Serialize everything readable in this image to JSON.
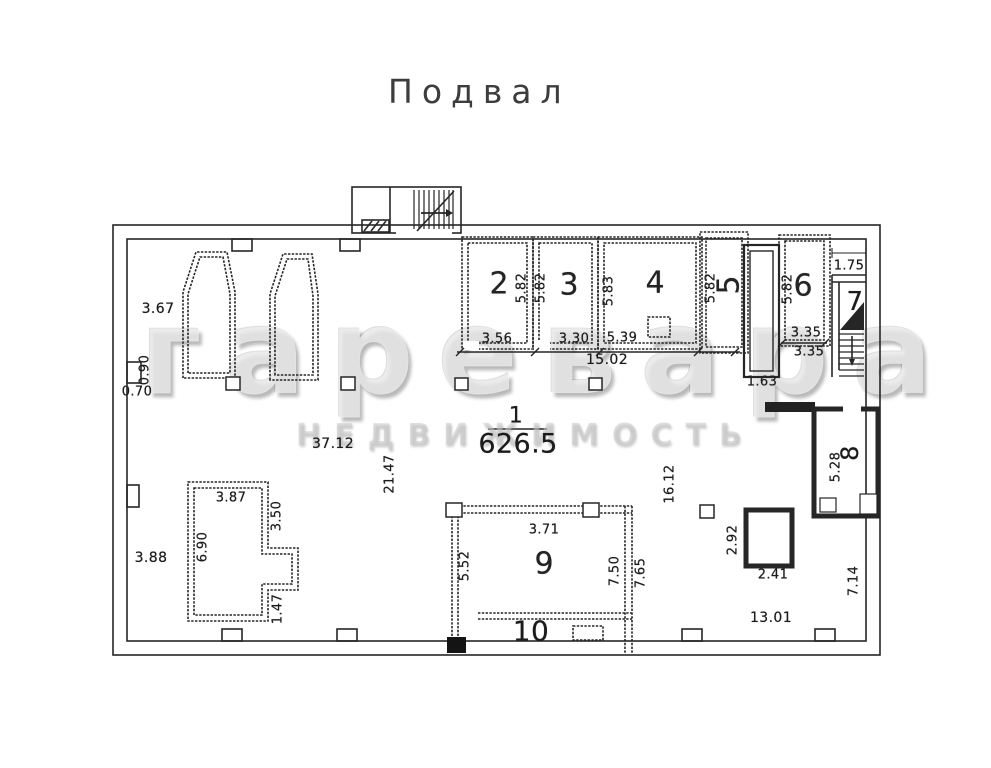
{
  "title": "Подвал",
  "watermark": {
    "brand": "гаревара",
    "subtitle": "НЕДВИЖИМОСТЬ"
  },
  "hall": {
    "number": "1",
    "area": "626.5",
    "width": "37.12",
    "height_left": "21.47",
    "height_right": "16.12",
    "top_rooms_span": "15.02"
  },
  "left_wall": {
    "top_segment": "3.67",
    "niche_depth": "0.90",
    "niche_width": "0.70",
    "bottom_segment": "3.88"
  },
  "top_rooms": {
    "room2": {
      "number": "2",
      "height": "5.82",
      "width": "3.56"
    },
    "room3": {
      "number": "3",
      "height": "5.82",
      "width": "3.30"
    },
    "room4": {
      "number": "4",
      "height": "5.83",
      "width": "5.39"
    },
    "room5": {
      "number": "5",
      "height": "5.82"
    },
    "shaft": {
      "width": "1.63"
    },
    "room6": {
      "number": "6",
      "height": "5.82",
      "width_inner": "3.35",
      "width_outer": "3.35"
    },
    "room7": {
      "number": "7",
      "niche_width": "1.75"
    }
  },
  "right_side": {
    "room8": {
      "number": "8",
      "height": "5.28"
    },
    "pillar": {
      "height": "2.92",
      "width": "2.41"
    },
    "bottom_span": "13.01",
    "wall_segment": "7.14"
  },
  "bottom_rooms": {
    "storeroom": {
      "width": "3.87",
      "height_left": "6.90",
      "upper_right": "3.50",
      "lower_right": "1.47"
    },
    "room9": {
      "number": "9",
      "width": "3.71",
      "height_left": "5.52",
      "height_right_inner": "7.50",
      "height_right_outer": "7.65"
    },
    "room10": {
      "number": "10"
    }
  }
}
